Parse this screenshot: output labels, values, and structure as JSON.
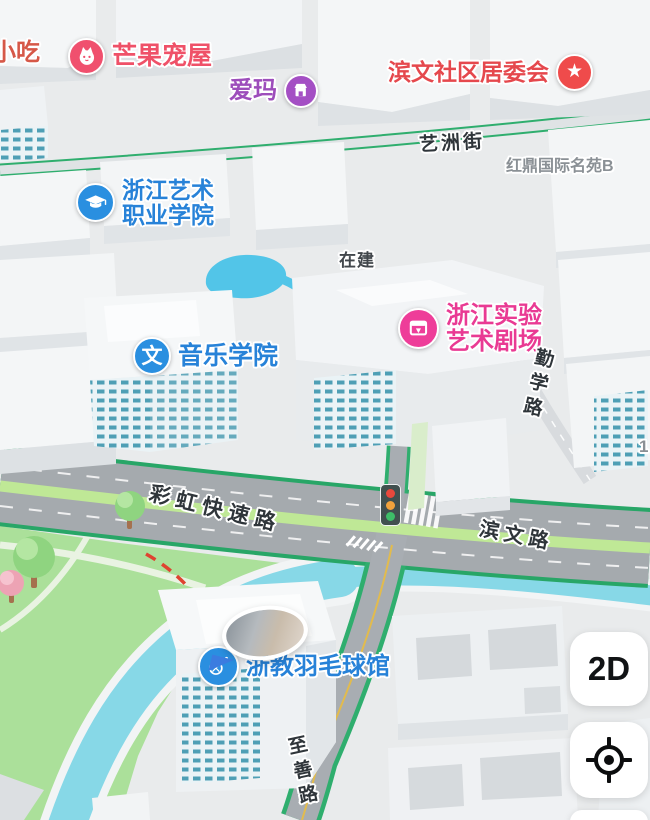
{
  "pois": {
    "snack": {
      "label": "小吃",
      "color": "#d65848"
    },
    "mango_pet_house": {
      "label": "芒果宠屋",
      "color": "#ef5168",
      "icon": "cat-icon"
    },
    "aima": {
      "label": "爱玛",
      "color": "#9d4dbb",
      "icon": "shop-icon"
    },
    "binwen_community_committee": {
      "label": "滨文社区居委会",
      "color": "#e5484d",
      "icon": "star-icon",
      "star_glyph": "★"
    },
    "zhejiang_art_vocational_college": {
      "line1": "浙江艺术",
      "line2": "职业学院",
      "color": "#2782d8",
      "icon": "graduation-cap-icon"
    },
    "zhejiang_experimental_art_theater": {
      "line1": "浙江实验",
      "line2": "艺术剧场",
      "color": "#e93a93",
      "icon": "theater-icon"
    },
    "music_school": {
      "label": "音乐学院",
      "color": "#2782d8",
      "icon": "wen-icon",
      "icon_glyph": "文"
    },
    "zhejiao_badminton_hall": {
      "label": "浙教羽毛球馆",
      "color": "#2782d8",
      "icon": "badminton-icon"
    }
  },
  "road_labels": {
    "yizhou_street": "艺洲街",
    "qinxue_road": "勤学路",
    "caihong_expressway": "彩虹快速路",
    "binwen_road": "滨文路",
    "zhishan_road": "至善路"
  },
  "area_labels": {
    "hongding_compound": "红鼎国际名苑B",
    "under_construction": "在建",
    "number_fragment": "1"
  },
  "controls": {
    "view_mode_button": "2D",
    "locate_button_icon": "gps-crosshair"
  },
  "map_colors": {
    "road_edge_green": "#28a667",
    "road_asphalt": "#a5aaae",
    "road_median_green": "#bfe896",
    "water": "#87d8e7",
    "park_green": "#abe09a",
    "bank_dash_red": "#df4330",
    "poi_blue": "#2a8fe0",
    "poi_magenta": "#ee3d99"
  }
}
